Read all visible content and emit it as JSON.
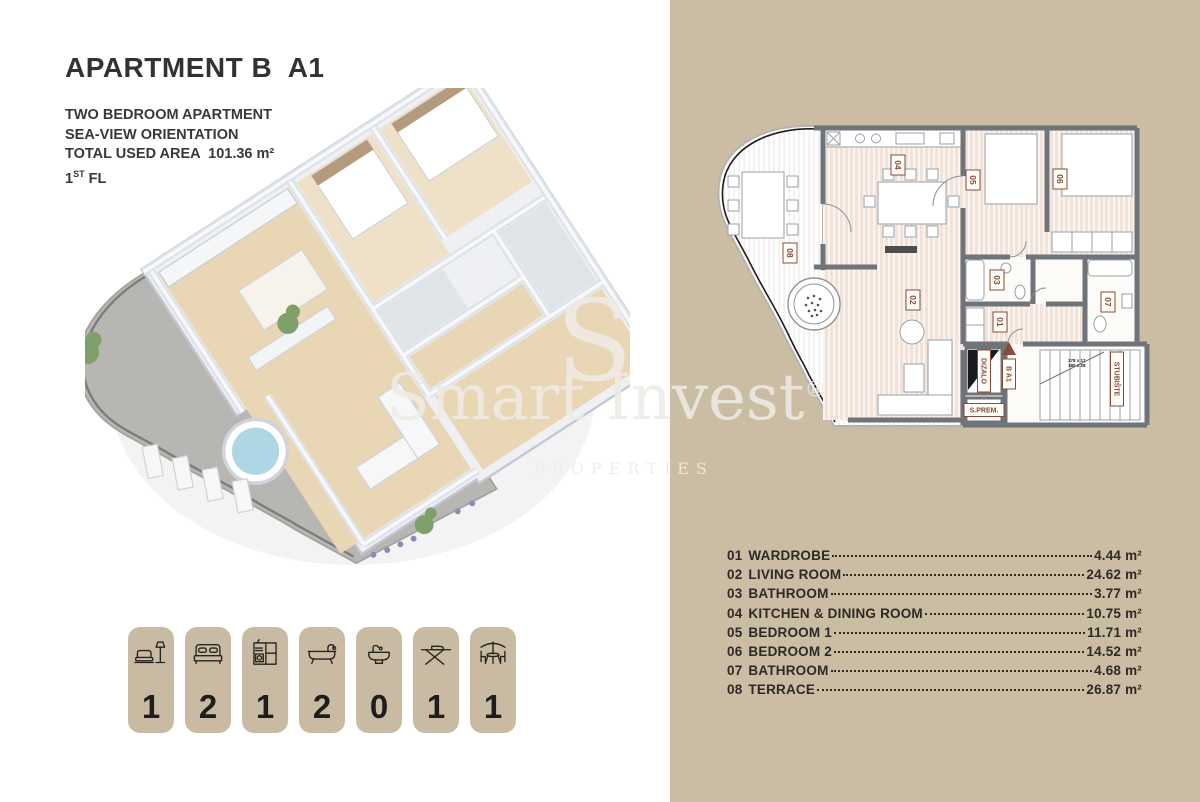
{
  "header": {
    "title": "APARTMENT B  A1",
    "subtitle_lines": [
      "TWO BEDROOM APARTMENT",
      "SEA-VIEW ORIENTATION",
      "TOTAL USED AREA  101.36 m²"
    ],
    "floor_line": {
      "number": "1",
      "ordinal": "ST",
      "rest": " FL"
    }
  },
  "watermark": {
    "initial": "S",
    "brand": "Smart Invest",
    "registered": "®",
    "tagline": "PROPERTIES"
  },
  "rooms": [
    {
      "number": "01",
      "name": "WARDROBE",
      "area": "4.44 m²"
    },
    {
      "number": "02",
      "name": "LIVING ROOM",
      "area": "24.62 m²"
    },
    {
      "number": "03",
      "name": "BATHROOM",
      "area": "3.77 m²"
    },
    {
      "number": "04",
      "name": "KITCHEN & DINING ROOM",
      "area": "10.75 m²"
    },
    {
      "number": "05",
      "name": "BEDROOM 1",
      "area": "11.71 m²"
    },
    {
      "number": "06",
      "name": "BEDROOM 2",
      "area": "14.52 m²"
    },
    {
      "number": "07",
      "name": "BATHROOM",
      "area": "4.68 m²"
    },
    {
      "number": "08",
      "name": "TERRACE",
      "area": "26.87 m²"
    }
  ],
  "amenities": [
    {
      "icon": "sofa-lamp-icon",
      "count": "1"
    },
    {
      "icon": "double-bed-icon",
      "count": "2"
    },
    {
      "icon": "kitchen-unit-icon",
      "count": "1"
    },
    {
      "icon": "bathtub-icon",
      "count": "2"
    },
    {
      "icon": "washbasin-icon",
      "count": "0"
    },
    {
      "icon": "ironing-board-icon",
      "count": "1"
    },
    {
      "icon": "patio-table-icon",
      "count": "1"
    }
  ],
  "floorplan_2d": {
    "labels": {
      "elevator": "DIZALO",
      "unit": "B A1",
      "storage": "S.PREM.",
      "staircase": "STUBIŠTE",
      "stair_dim_1": "178 x 17",
      "stair_dim_2": "180 x 28"
    }
  },
  "colors": {
    "panel_tan": "#cbbda4",
    "badge_tan": "#c9bba3",
    "wall_gray": "#6f737a",
    "room_stripe": "#f2e3da",
    "label_red": "#8a4a38",
    "text_dark": "#2d2a26"
  }
}
